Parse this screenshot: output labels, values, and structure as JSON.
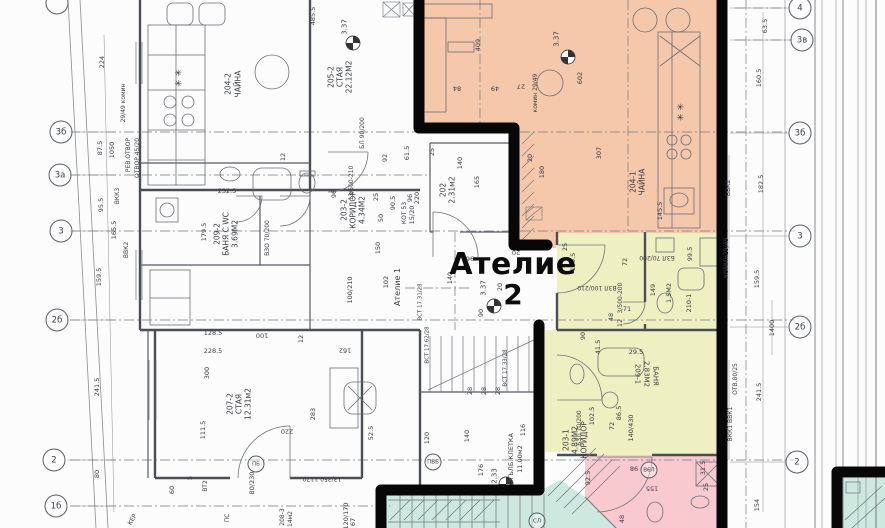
{
  "unit": {
    "name": "Ателие",
    "number": "2"
  },
  "colors": {
    "highlight_orange": "#f5c8ab",
    "highlight_yellow": "#eef0c2",
    "highlight_pink": "#f8cad0",
    "highlight_teal": "#cde8df",
    "boundary_black": "#070707",
    "line_gray": "#70747c",
    "wall_gray": "#4a4e55",
    "text_gray": "#3a3d44"
  },
  "bubbles": [
    {
      "t": "",
      "x": 57,
      "y": 3
    },
    {
      "t": "3б",
      "x": 61,
      "y": 132
    },
    {
      "t": "3а",
      "x": 60,
      "y": 175
    },
    {
      "t": "3",
      "x": 61,
      "y": 231
    },
    {
      "t": "2б",
      "x": 57,
      "y": 320
    },
    {
      "t": "2",
      "x": 54,
      "y": 460
    },
    {
      "t": "1б",
      "x": 56,
      "y": 506
    },
    {
      "t": "4",
      "x": 800,
      "y": 8
    },
    {
      "t": "3в",
      "x": 802,
      "y": 40
    },
    {
      "t": "3б",
      "x": 800,
      "y": 133
    },
    {
      "t": "3",
      "x": 800,
      "y": 236
    },
    {
      "t": "2б",
      "x": 800,
      "y": 327
    },
    {
      "t": "2",
      "x": 797,
      "y": 462
    }
  ],
  "circle_labels": [
    {
      "t": "ПБ",
      "x": 256,
      "y": 464
    },
    {
      "t": "ПВБ",
      "x": 433,
      "y": 462
    },
    {
      "t": "В6Л",
      "x": 649,
      "y": 470
    },
    {
      "t": "СЛ",
      "x": 537,
      "y": 521
    }
  ],
  "texts": [
    {
      "t": "224",
      "x": 102,
      "y": 62,
      "r": -90
    },
    {
      "t": "87.5",
      "x": 100,
      "y": 148,
      "r": -90
    },
    {
      "t": "1050",
      "x": 112,
      "y": 150,
      "r": -90
    },
    {
      "t": "95.5",
      "x": 101,
      "y": 205,
      "r": -90
    },
    {
      "t": "159.5",
      "x": 99,
      "y": 277,
      "r": -90
    },
    {
      "t": "241.5",
      "x": 97,
      "y": 387,
      "r": -90
    },
    {
      "t": "80",
      "x": 97,
      "y": 474,
      "r": -90
    },
    {
      "t": "29/49 комин",
      "x": 124,
      "y": 103,
      "r": -90,
      "s": 6
    },
    {
      "t": "ВКК3",
      "x": 118,
      "y": 196,
      "r": -90,
      "s": 6
    },
    {
      "t": "РЕВ.ОТВОР",
      "x": 129,
      "y": 155,
      "r": -90,
      "s": 6
    },
    {
      "t": "ОТВОР 45/20",
      "x": 138,
      "y": 158,
      "r": -90,
      "s": 6
    },
    {
      "t": "ВВК2",
      "x": 127,
      "y": 250,
      "r": -90,
      "s": 6
    },
    {
      "t": "165.5",
      "x": 114,
      "y": 230,
      "r": -90
    },
    {
      "t": "✳ ✳",
      "x": 180,
      "y": 78,
      "r": -90,
      "s": 9
    },
    {
      "t": "204-2",
      "x": 228,
      "y": 84,
      "r": -90,
      "s": 7.5
    },
    {
      "t": "ЧАЙНА",
      "x": 238,
      "y": 84,
      "r": -90,
      "s": 7.5
    },
    {
      "t": "205-2",
      "x": 331,
      "y": 77,
      "r": -90,
      "s": 7.5
    },
    {
      "t": "СТАЯ",
      "x": 340,
      "y": 77,
      "r": -90,
      "s": 7.5
    },
    {
      "t": "22.12М2",
      "x": 349,
      "y": 77,
      "r": -90,
      "s": 7.5
    },
    {
      "t": "485.5",
      "x": 313,
      "y": 16,
      "r": -90
    },
    {
      "t": "3.37",
      "x": 345,
      "y": 27,
      "r": -90,
      "s": 7
    },
    {
      "t": "232.5",
      "x": 227,
      "y": 191
    },
    {
      "t": "179.5",
      "x": 204,
      "y": 232,
      "r": -90
    },
    {
      "t": "12",
      "x": 283,
      "y": 157,
      "r": -90
    },
    {
      "t": "92",
      "x": 385,
      "y": 158,
      "r": -90
    },
    {
      "t": "БЛ 90/200",
      "x": 363,
      "y": 133,
      "r": -90,
      "s": 6
    },
    {
      "t": "ВЗО 70/200",
      "x": 268,
      "y": 238,
      "r": -90,
      "s": 6
    },
    {
      "t": "209-2",
      "x": 217,
      "y": 234,
      "r": -90,
      "s": 7.5
    },
    {
      "t": "БАНЯ С WC",
      "x": 226,
      "y": 234,
      "r": -90,
      "s": 7.5
    },
    {
      "t": "3.69М2",
      "x": 235,
      "y": 234,
      "r": -90,
      "s": 7.5
    },
    {
      "t": "203-2",
      "x": 344,
      "y": 210,
      "r": -90,
      "s": 7.5
    },
    {
      "t": "КОРИДОР",
      "x": 353,
      "y": 210,
      "r": -90,
      "s": 7.5
    },
    {
      "t": "4.34М2",
      "x": 362,
      "y": 210,
      "r": -90,
      "s": 7.5
    },
    {
      "t": "13/500-210",
      "x": 352,
      "y": 183,
      "r": -90,
      "s": 6
    },
    {
      "t": "90.5",
      "x": 393,
      "y": 203,
      "r": -90
    },
    {
      "t": "КОТ 53",
      "x": 405,
      "y": 213,
      "r": -90,
      "s": 6
    },
    {
      "t": "96",
      "x": 334,
      "y": 194,
      "r": -90
    },
    {
      "t": "25",
      "x": 376,
      "y": 197,
      "r": -90
    },
    {
      "t": "50",
      "x": 381,
      "y": 218,
      "r": -90
    },
    {
      "t": "150",
      "x": 378,
      "y": 248,
      "r": -90
    },
    {
      "t": "102",
      "x": 386,
      "y": 282,
      "r": -90
    },
    {
      "t": "100/210",
      "x": 350,
      "y": 290,
      "r": -90
    },
    {
      "t": "Ателие 1",
      "x": 398,
      "y": 287,
      "r": -90,
      "s": 8
    },
    {
      "t": "207-2",
      "x": 230,
      "y": 404,
      "r": -90,
      "s": 7.5
    },
    {
      "t": "СТАЯ",
      "x": 239,
      "y": 404,
      "r": -90,
      "s": 7.5
    },
    {
      "t": "12.31м2",
      "x": 248,
      "y": 404,
      "r": -90,
      "s": 7.5
    },
    {
      "t": "409",
      "x": 478,
      "y": 45,
      "r": -90
    },
    {
      "t": "602",
      "x": 580,
      "y": 78,
      "r": -90
    },
    {
      "t": "84",
      "x": 457,
      "y": 88,
      "r": 180
    },
    {
      "t": "49",
      "x": 495,
      "y": 88,
      "r": 180
    },
    {
      "t": "27",
      "x": 521,
      "y": 86,
      "r": 180
    },
    {
      "t": "комин 29/49",
      "x": 536,
      "y": 93,
      "r": -90,
      "s": 6
    },
    {
      "t": "3.37",
      "x": 557,
      "y": 39,
      "r": -90,
      "s": 7
    },
    {
      "t": "307",
      "x": 599,
      "y": 153,
      "r": -90
    },
    {
      "t": "204-1",
      "x": 633,
      "y": 182,
      "r": -90,
      "s": 7.5
    },
    {
      "t": "ЧАЙНА",
      "x": 642,
      "y": 182,
      "r": -90,
      "s": 7.5
    },
    {
      "t": "✳ ✳",
      "x": 682,
      "y": 112,
      "r": -90,
      "s": 9
    },
    {
      "t": "145.5",
      "x": 660,
      "y": 211,
      "r": -90
    },
    {
      "t": "20",
      "x": 530,
      "y": 158,
      "r": -90
    },
    {
      "t": "180",
      "x": 542,
      "y": 172,
      "r": -90
    },
    {
      "t": "61.5",
      "x": 407,
      "y": 153,
      "r": -90
    },
    {
      "t": "25",
      "x": 432,
      "y": 152,
      "r": -90
    },
    {
      "t": "140",
      "x": 460,
      "y": 163,
      "r": -90
    },
    {
      "t": "165",
      "x": 477,
      "y": 182,
      "r": -90
    },
    {
      "t": "96",
      "x": 410,
      "y": 198,
      "r": -90
    },
    {
      "t": "220",
      "x": 417,
      "y": 198,
      "r": -90
    },
    {
      "t": "202",
      "x": 443,
      "y": 190,
      "r": -90,
      "s": 7.5
    },
    {
      "t": "2.31м2",
      "x": 452,
      "y": 190,
      "r": -90,
      "s": 7.5
    },
    {
      "t": "15/20",
      "x": 412,
      "y": 215,
      "r": -90
    },
    {
      "t": "140",
      "x": 450,
      "y": 278,
      "r": -90
    },
    {
      "t": "96",
      "x": 470,
      "y": 258,
      "r": 180
    },
    {
      "t": "20",
      "x": 516,
      "y": 252,
      "r": 180
    },
    {
      "t": "20",
      "x": 500,
      "y": 287,
      "r": -90
    },
    {
      "t": "3.37",
      "x": 484,
      "y": 288,
      "r": -90,
      "s": 7
    },
    {
      "t": "90",
      "x": 481,
      "y": 313,
      "r": -90
    },
    {
      "t": "25",
      "x": 565,
      "y": 247,
      "r": -90
    },
    {
      "t": "139.5",
      "x": 573,
      "y": 262,
      "r": -90
    },
    {
      "t": "72",
      "x": 625,
      "y": 262,
      "r": -90
    },
    {
      "t": "Б3Л 70/200",
      "x": 657,
      "y": 257,
      "r": 180,
      "s": 6
    },
    {
      "t": "99.5",
      "x": 690,
      "y": 254,
      "r": -90
    },
    {
      "t": "ВЗЛ 100/210",
      "x": 597,
      "y": 287,
      "r": 180,
      "s": 6
    },
    {
      "t": "3/500-200",
      "x": 621,
      "y": 298,
      "r": -90,
      "s": 6
    },
    {
      "t": "149",
      "x": 653,
      "y": 290,
      "r": -90
    },
    {
      "t": "1.5М2",
      "x": 669,
      "y": 293,
      "r": -90
    },
    {
      "t": "210-1",
      "x": 689,
      "y": 303,
      "r": -90
    },
    {
      "t": "71",
      "x": 627,
      "y": 309
    },
    {
      "t": "12",
      "x": 620,
      "y": 323,
      "r": -90
    },
    {
      "t": "48",
      "x": 611,
      "y": 317,
      "r": -90
    },
    {
      "t": "90",
      "x": 583,
      "y": 336,
      "r": -90
    },
    {
      "t": "41.5",
      "x": 598,
      "y": 347,
      "r": -90
    },
    {
      "t": "29.5",
      "x": 636,
      "y": 352
    },
    {
      "t": "209-1",
      "x": 637,
      "y": 374,
      "r": 90,
      "s": 7
    },
    {
      "t": "2.83М2",
      "x": 646,
      "y": 374,
      "r": 90,
      "s": 7
    },
    {
      "t": "БАНЯ",
      "x": 655,
      "y": 376,
      "r": 90,
      "s": 7
    },
    {
      "t": "102.5",
      "x": 592,
      "y": 416,
      "r": -90
    },
    {
      "t": "86.5",
      "x": 619,
      "y": 413,
      "r": -90
    },
    {
      "t": "140/430",
      "x": 631,
      "y": 428,
      "r": -90
    },
    {
      "t": "72",
      "x": 612,
      "y": 426,
      "r": -90
    },
    {
      "t": "Б3Л 70/200",
      "x": 580,
      "y": 428,
      "r": -90,
      "s": 6
    },
    {
      "t": "203-1",
      "x": 566,
      "y": 440,
      "r": -90,
      "s": 7.5
    },
    {
      "t": "4.89М2",
      "x": 575,
      "y": 440,
      "r": -90,
      "s": 7.5
    },
    {
      "t": "КОРИДОР",
      "x": 584,
      "y": 440,
      "r": -90,
      "s": 7.5
    },
    {
      "t": "92.5",
      "x": 588,
      "y": 478,
      "r": -90
    },
    {
      "t": "155",
      "x": 652,
      "y": 488,
      "r": 180
    },
    {
      "t": "98",
      "x": 634,
      "y": 468,
      "r": 180
    },
    {
      "t": "31.5",
      "x": 703,
      "y": 468,
      "r": -90
    },
    {
      "t": "25",
      "x": 706,
      "y": 487,
      "r": -90
    },
    {
      "t": "48",
      "x": 622,
      "y": 519,
      "r": -90
    },
    {
      "t": "111.5",
      "x": 203,
      "y": 430,
      "r": -90
    },
    {
      "t": "300",
      "x": 207,
      "y": 373,
      "r": -90
    },
    {
      "t": "228.5",
      "x": 213,
      "y": 351
    },
    {
      "t": "128.5",
      "x": 213,
      "y": 333
    },
    {
      "t": "100",
      "x": 262,
      "y": 335,
      "r": 180
    },
    {
      "t": "12",
      "x": 301,
      "y": 339,
      "r": -90
    },
    {
      "t": "162",
      "x": 345,
      "y": 350,
      "r": 180
    },
    {
      "t": "220",
      "x": 287,
      "y": 431,
      "r": 180
    },
    {
      "t": "283",
      "x": 313,
      "y": 414,
      "r": -90
    },
    {
      "t": "52.5",
      "x": 371,
      "y": 433,
      "r": -90
    },
    {
      "t": "13/350-1170",
      "x": 322,
      "y": 478,
      "r": 180,
      "s": 6
    },
    {
      "t": "80/230",
      "x": 252,
      "y": 483,
      "r": -90
    },
    {
      "t": "ВТ2",
      "x": 206,
      "y": 486,
      "r": -90,
      "s": 6
    },
    {
      "t": "60",
      "x": 172,
      "y": 490,
      "r": -90
    },
    {
      "t": "5",
      "x": 190,
      "y": 478,
      "r": -90
    },
    {
      "t": "120/170",
      "x": 346,
      "y": 516,
      "r": -90
    },
    {
      "t": "67",
      "x": 353,
      "y": 522,
      "r": -90
    },
    {
      "t": "КЕР",
      "x": 133,
      "y": 520,
      "r": -60,
      "s": 6
    },
    {
      "t": "ПС",
      "x": 228,
      "y": 518,
      "r": -90,
      "s": 6
    },
    {
      "t": "208-3",
      "x": 283,
      "y": 517,
      "r": -90,
      "s": 6
    },
    {
      "t": "14м2",
      "x": 291,
      "y": 519,
      "r": -90,
      "s": 6
    },
    {
      "t": "ВСТ 17.31/28",
      "x": 421,
      "y": 302,
      "r": -90,
      "s": 5.5
    },
    {
      "t": "ВСТ 17.62/28",
      "x": 428,
      "y": 345,
      "r": -90,
      "s": 5.5
    },
    {
      "t": "ВСТ 17.33/28",
      "x": 506,
      "y": 368,
      "r": -90,
      "s": 5.5
    },
    {
      "t": "28",
      "x": 470,
      "y": 391,
      "r": -90
    },
    {
      "t": "28",
      "x": 484,
      "y": 391,
      "r": -90
    },
    {
      "t": "28",
      "x": 498,
      "y": 391,
      "r": -90
    },
    {
      "t": "120",
      "x": 427,
      "y": 438,
      "r": -90
    },
    {
      "t": "140",
      "x": 467,
      "y": 436,
      "r": -90
    },
    {
      "t": "176",
      "x": 481,
      "y": 470,
      "r": -90
    },
    {
      "t": "116",
      "x": 523,
      "y": 430,
      "r": -90
    },
    {
      "t": "СТЪЛБ.КЛЕТКА",
      "x": 511,
      "y": 459,
      "r": -90,
      "s": 6.5
    },
    {
      "t": "11.00м2",
      "x": 520,
      "y": 459,
      "r": -90,
      "s": 6.5
    },
    {
      "t": "2.33",
      "x": 495,
      "y": 476,
      "r": -90,
      "s": 7
    },
    {
      "t": "63.5",
      "x": 765,
      "y": 26,
      "r": -90
    },
    {
      "t": "160.5",
      "x": 759,
      "y": 78,
      "r": -90
    },
    {
      "t": "182.5",
      "x": 761,
      "y": 184,
      "r": -90
    },
    {
      "t": "159.5",
      "x": 757,
      "y": 279,
      "r": -90
    },
    {
      "t": "1400",
      "x": 772,
      "y": 328,
      "r": -90
    },
    {
      "t": "241.5",
      "x": 759,
      "y": 392,
      "r": -90
    },
    {
      "t": "154",
      "x": 757,
      "y": 505,
      "r": -90
    },
    {
      "t": "КОМИН29/49",
      "x": 727,
      "y": 258,
      "r": -90,
      "s": 6
    },
    {
      "t": "ОТВ.80/25",
      "x": 736,
      "y": 379,
      "r": -90,
      "s": 6
    },
    {
      "t": "ВВК2",
      "x": 729,
      "y": 188,
      "r": -90,
      "s": 6
    },
    {
      "t": "ВКК1 ВВК1",
      "x": 731,
      "y": 424,
      "r": -90,
      "s": 6
    }
  ]
}
